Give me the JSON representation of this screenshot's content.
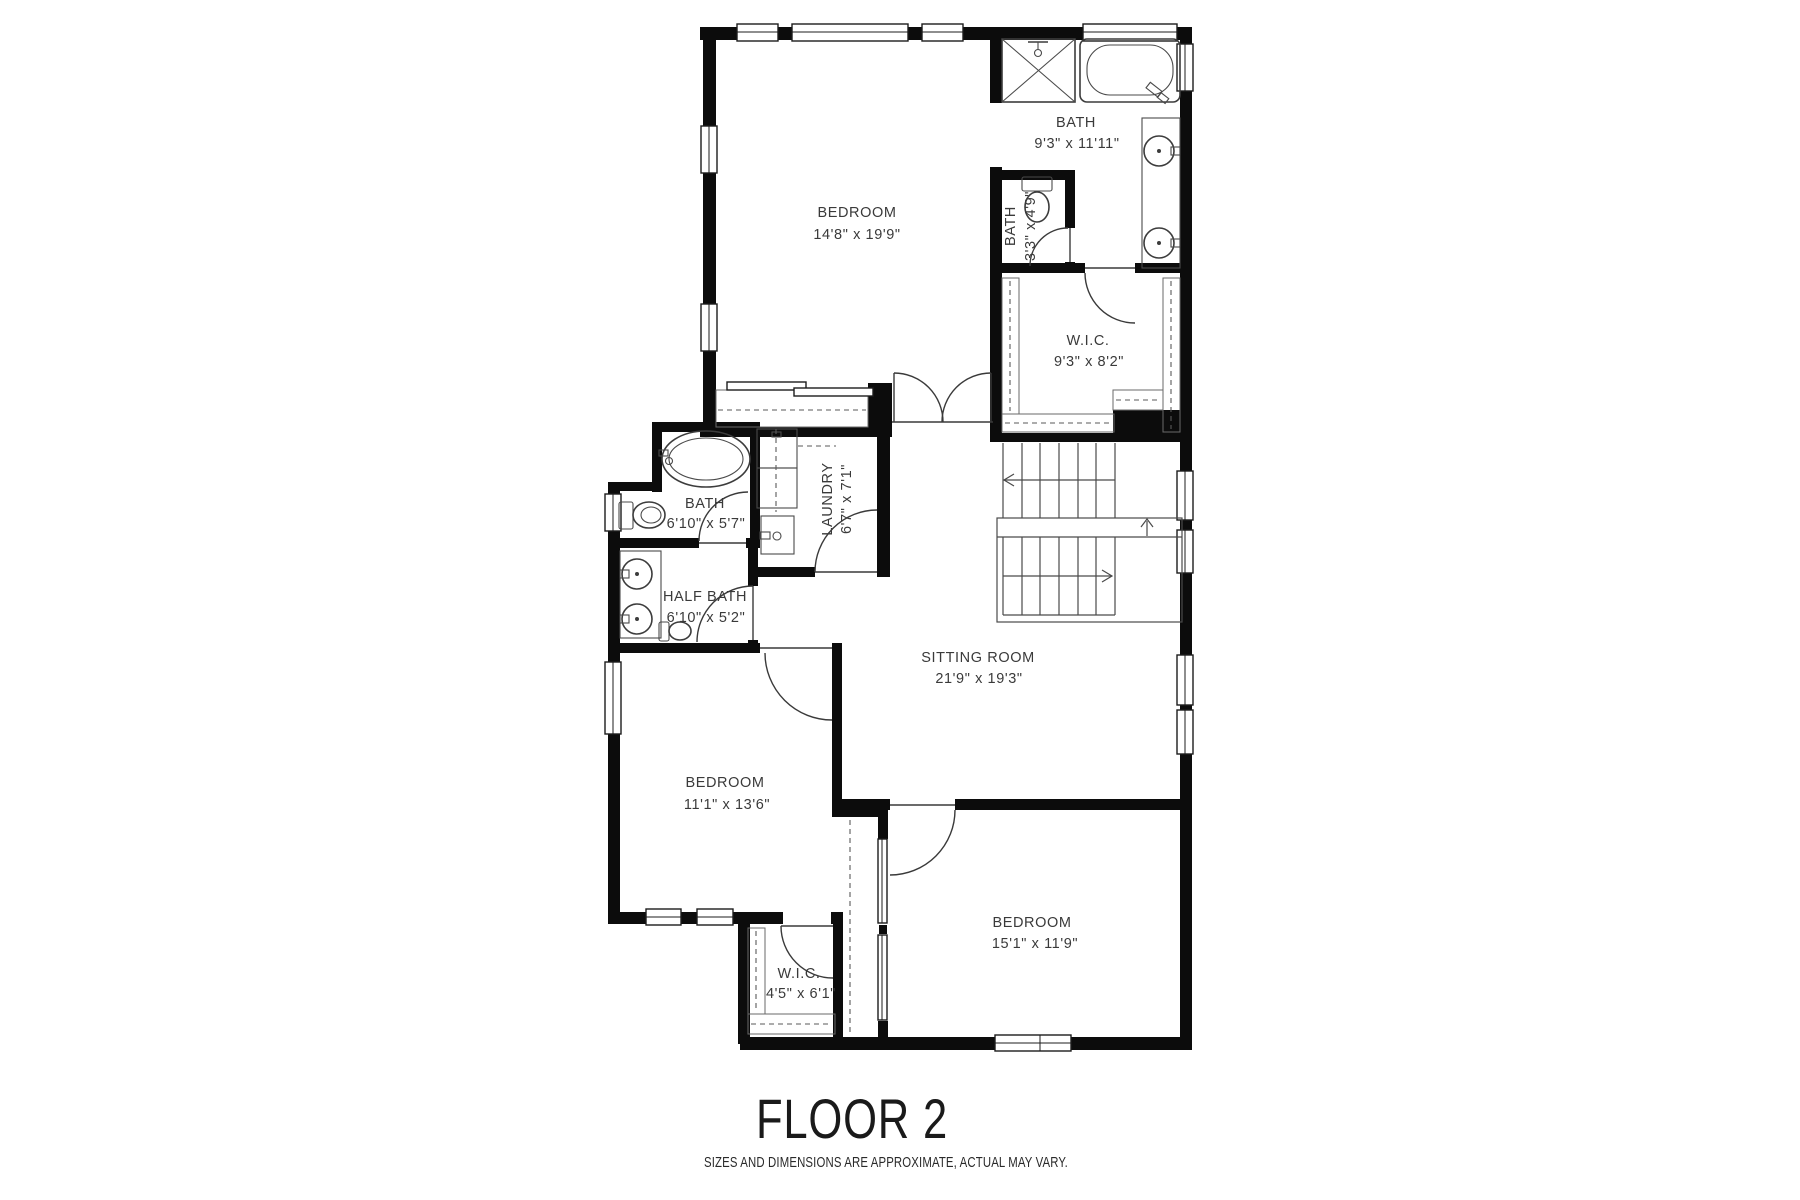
{
  "plan": {
    "title": "FLOOR 2",
    "disclaimer": "SIZES AND DIMENSIONS ARE APPROXIMATE, ACTUAL MAY VARY.",
    "colors": {
      "wall": "#0c0c0c",
      "line": "#3c3c3c",
      "text": "#3a3a3a",
      "background": "#ffffff"
    },
    "rooms": [
      {
        "name": "BEDROOM",
        "dims": "14'8\" x 19'9\""
      },
      {
        "name": "BATH",
        "dims": "9'3\" x 11'11\""
      },
      {
        "name": "BATH",
        "dims": "3'3\" x 4'9\""
      },
      {
        "name": "W.I.C.",
        "dims": "9'3\" x 8'2\""
      },
      {
        "name": "LAUNDRY",
        "dims": "6'7\" x 7'1\""
      },
      {
        "name": "BATH",
        "dims": "6'10\" x 5'7\""
      },
      {
        "name": "HALF BATH",
        "dims": "6'10\" x 5'2\""
      },
      {
        "name": "SITTING ROOM",
        "dims": "21'9\" x 19'3\""
      },
      {
        "name": "BEDROOM",
        "dims": "11'1\" x 13'6\""
      },
      {
        "name": "BEDROOM",
        "dims": "15'1\" x 11'9\""
      },
      {
        "name": "W.I.C.",
        "dims": "4'5\" x 6'1\""
      }
    ]
  }
}
